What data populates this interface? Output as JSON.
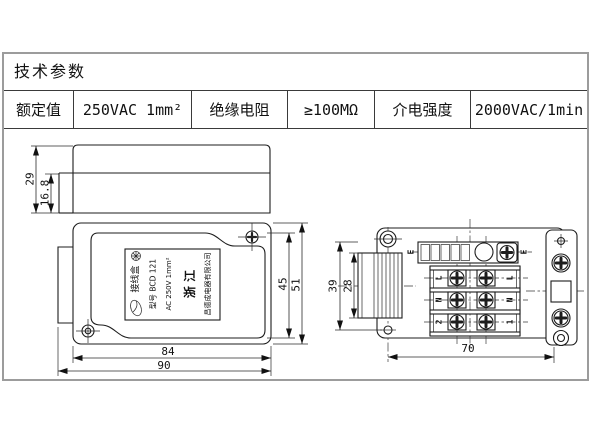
{
  "colors": {
    "line": "#1c1c1c",
    "frame": "#9c9c9c",
    "background": "#ffffff"
  },
  "table": {
    "title": "技术参数",
    "cells": [
      "额定值",
      "250VAC 1mm²",
      "绝缘电阻",
      "≥100MΩ",
      "介电强度",
      "2000VAC/1min"
    ]
  },
  "side_view": {
    "dims": {
      "total_height": "29",
      "lower_height": "16.8"
    }
  },
  "plan_view": {
    "dims": {
      "body_width": "84",
      "total_width": "90",
      "inner_height": "45",
      "total_height": "51"
    },
    "label": {
      "product": "接线盒",
      "model": "型号 BCD 121",
      "rating": "AC 250V 1mm²",
      "region": "浙 江",
      "company": "昌德成电器有限公司"
    }
  },
  "terminal_view": {
    "dims": {
      "span": "70",
      "connector_inner": "28",
      "connector_outer": "39"
    },
    "terminals": {
      "earth_left": "E",
      "earth_right": "E",
      "left_rows": [
        "L",
        "N",
        "2"
      ],
      "right_rows": [
        "L",
        "N",
        "1"
      ]
    }
  }
}
